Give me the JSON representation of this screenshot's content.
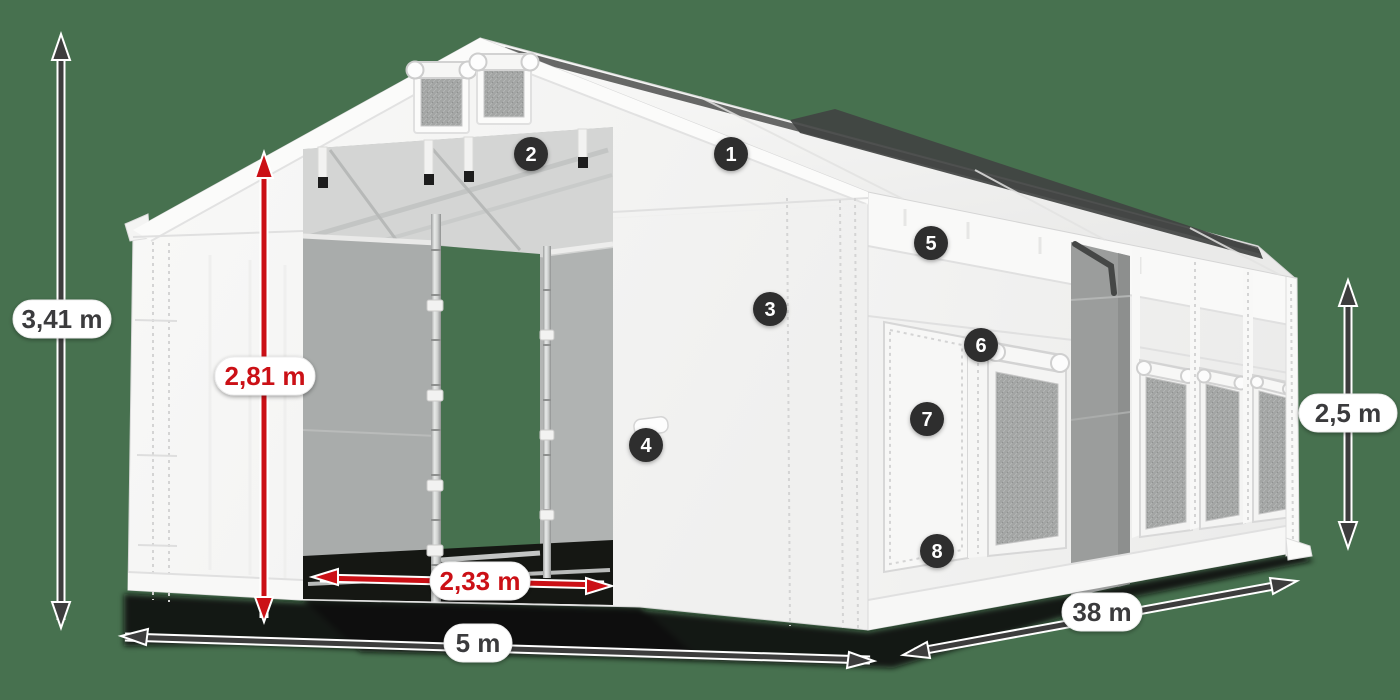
{
  "scene": {
    "type": "tent-size-diagram",
    "background_color": "#47714f",
    "accent_red": "#cb1016",
    "arrow_color": "#3d3d3d",
    "badge_color": "#2d2d2d",
    "tent_color": "#f6f6f5"
  },
  "dimensions": {
    "total_height": "3,41 m",
    "inner_height": "2,81 m",
    "door_width": "2,33 m",
    "width": "5 m",
    "length": "38 m",
    "side_height": "2,5 m"
  },
  "callouts": [
    {
      "label": "1"
    },
    {
      "label": "2"
    },
    {
      "label": "3"
    },
    {
      "label": "4"
    },
    {
      "label": "5"
    },
    {
      "label": "6"
    },
    {
      "label": "7"
    },
    {
      "label": "8"
    }
  ]
}
